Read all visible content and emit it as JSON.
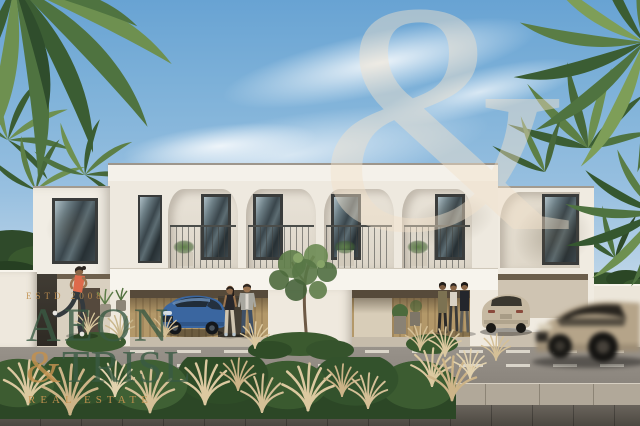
{
  "watermark": {
    "estd": "ESTD 2008",
    "brand_top": "AEON",
    "brand_amp": "&",
    "brand_bottom": "TRISL",
    "tagline": "REAL ESTATE",
    "sky_glyph": "&",
    "brand_green": "#3a5a44",
    "brand_gold": "#c2914f"
  },
  "scene": {
    "subject": "modern two-storey white townhouses with carports, palm trees, people and street",
    "elements": [
      "palm-tree",
      "townhouse-facade",
      "balcony",
      "carport",
      "blue-car",
      "beige-suv",
      "moving-suv",
      "jogger",
      "walking-couple",
      "standing-group",
      "street-tree",
      "hedge",
      "pampas-grass",
      "road",
      "sidewalk"
    ],
    "palette": {
      "sky_blue": "#7fb2d9",
      "cloud_white": "#ffffff",
      "facade_white": "#f2eee6",
      "facade_shade": "#ddd5c7",
      "window_frame": "#3a3c3b",
      "wood_tan": "#b0956a",
      "palm_green": "#5d7f45",
      "hedge_green": "#33512c",
      "grass_wheat": "#d9c79e",
      "road_gray": "#8f8a82",
      "pavement_dark": "#55514b",
      "car_blue": "#3a66a0",
      "car_beige": "#b5a489"
    }
  }
}
